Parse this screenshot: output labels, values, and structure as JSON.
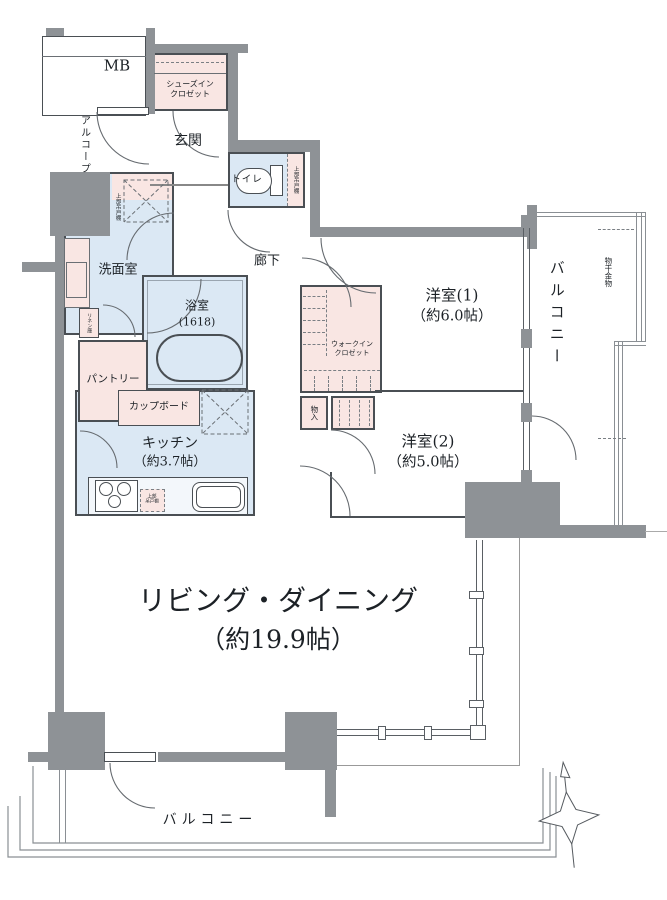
{
  "plan": {
    "colors": {
      "wall": "#8e9296",
      "water_rooms": "#dbe8f4",
      "closets": "#f9e6e3",
      "lines": "#4a4f54"
    },
    "rooms": {
      "mb": {
        "label": "MB"
      },
      "sic": {
        "l1": "シューズイン",
        "l2": "クロゼット"
      },
      "genkan": {
        "label": "玄関"
      },
      "alcove": {
        "label": "アルコープ"
      },
      "toilet": {
        "label": "トイレ"
      },
      "toilet_cabinet": {
        "label": "上部吊戸棚"
      },
      "washroom": {
        "label": "洗面室"
      },
      "washroom_cabinet": {
        "label": "上部吊戸棚"
      },
      "linen": {
        "label": "リネン庫"
      },
      "bath": {
        "label": "浴室",
        "size": "(1618)"
      },
      "pantry": {
        "label": "パントリー"
      },
      "cupboard": {
        "label": "カップボード"
      },
      "kitchen": {
        "label": "キッチン",
        "size": "（約3.7帖）"
      },
      "kitchen_cabinet": {
        "l1": "上部",
        "l2": "吊戸棚"
      },
      "hallway": {
        "label": "廊下"
      },
      "wic": {
        "l1": "ウォークイン",
        "l2": "クロゼット"
      },
      "storage": {
        "label": "物入"
      },
      "bedroom1": {
        "label": "洋室(1)",
        "size": "（約6.0帖）"
      },
      "bedroom2": {
        "label": "洋室(2)",
        "size": "（約5.0帖）"
      },
      "living": {
        "label": "リビング・ダイニング",
        "size": "（約19.9帖）"
      },
      "balcony_east": {
        "label": "バルコニー"
      },
      "balcony_south": {
        "label": "バルコニー"
      },
      "drying": {
        "label": "物干金物"
      }
    }
  }
}
